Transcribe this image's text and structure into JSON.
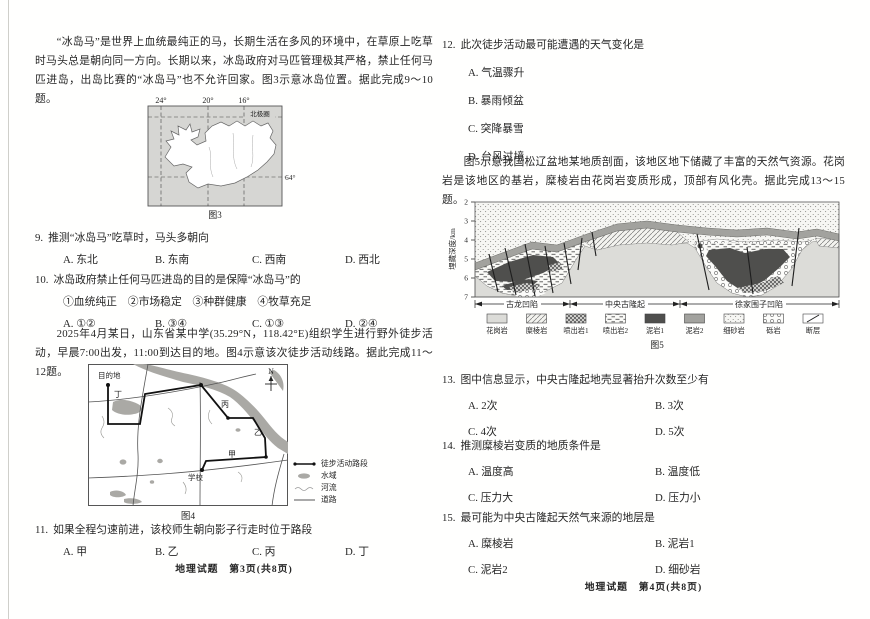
{
  "doc": {
    "footer_left": "地理试题　第3页(共8页)",
    "footer_right": "地理试题　第4页(共8页)"
  },
  "left": {
    "intro1": "“冰岛马”是世界上血统最纯正的马，长期生活在多风的环境中，在草原上吃草时马头总是朝向同一方向。长期以来，冰岛政府对马匹管理极其严格，禁止任何马匹进岛，出岛比赛的“冰岛马”也不允许回家。图3示意冰岛位置。据此完成9～10题。",
    "q9": {
      "label": "9.",
      "text": "推测“冰岛马”吃草时，马头多朝向",
      "options": [
        "A. 东北",
        "B. 东南",
        "C. 西南",
        "D. 西北"
      ]
    },
    "q10": {
      "label": "10.",
      "text": "冰岛政府禁止任何马匹进岛的目的是保障“冰岛马”的",
      "items": "①血统纯正　②市场稳定　③种群健康　④牧草充足",
      "options": [
        "A. ①②",
        "B. ③④",
        "C. ①③",
        "D. ②④"
      ]
    },
    "intro2": "2025年4月某日，山东省某中学(35.29°N，118.42°E)组织学生进行野外徒步活动，早晨7:00出发，11:00到达目的地。图4示意该次徒步活动线路。据此完成11～12题。",
    "q11": {
      "label": "11.",
      "text": "如果全程匀速前进，该校师生朝向影子行走时位于路段",
      "options": [
        "A. 甲",
        "B. 乙",
        "C. 丙",
        "D. 丁"
      ]
    },
    "fig3": {
      "caption": "图3",
      "lon": [
        "24°",
        "20°",
        "16°"
      ],
      "lat": "64°",
      "arctic": "北极圈"
    },
    "fig4": {
      "caption": "图4",
      "north": "N",
      "dest": "目的地",
      "jia": "甲",
      "yi": "乙",
      "bing": "丙",
      "ding": "丁",
      "school": "学校",
      "legend": [
        "徒步活动路段",
        "水域",
        "河流",
        "道路"
      ]
    }
  },
  "right": {
    "q12": {
      "label": "12.",
      "text": "此次徒步活动最可能遭遇的天气变化是",
      "options": [
        "A. 气温骤升",
        "B. 暴雨倾盆",
        "C. 突降暴雪",
        "D. 台风过境"
      ]
    },
    "intro3": "图5示意我国松辽盆地某地质剖面，该地区地下储藏了丰富的天然气资源。花岗岩是该地区的基岩，糜棱岩由花岗岩变质形成，顶部有风化壳。据此完成13～15题。",
    "q13": {
      "label": "13.",
      "text": "图中信息显示，中央古隆起地壳显著抬升次数至少有",
      "options": [
        "A. 2次",
        "B. 3次",
        "C. 4次",
        "D. 5次"
      ]
    },
    "q14": {
      "label": "14.",
      "text": "推测糜棱岩变质的地质条件是",
      "options": [
        "A. 温度高",
        "B. 温度低",
        "C. 压力大",
        "D. 压力小"
      ]
    },
    "q15": {
      "label": "15.",
      "text": "最可能为中央古隆起天然气来源的地层是",
      "options": [
        "A. 糜棱岩",
        "B. 泥岩1",
        "C. 泥岩2",
        "D. 细砂岩"
      ]
    },
    "fig5": {
      "caption": "图5",
      "ylabel": "埋藏深度/km",
      "ticks": [
        "2",
        "3",
        "4",
        "5",
        "6",
        "7"
      ],
      "zones": [
        "古龙凹陷",
        "中央古隆起",
        "徐家围子凹陷"
      ],
      "legend": [
        "花岗岩",
        "糜棱岩",
        "喷出岩1",
        "喷出岩2",
        "泥岩1",
        "泥岩2",
        "细砂岩",
        "砾岩",
        "断层"
      ]
    }
  }
}
